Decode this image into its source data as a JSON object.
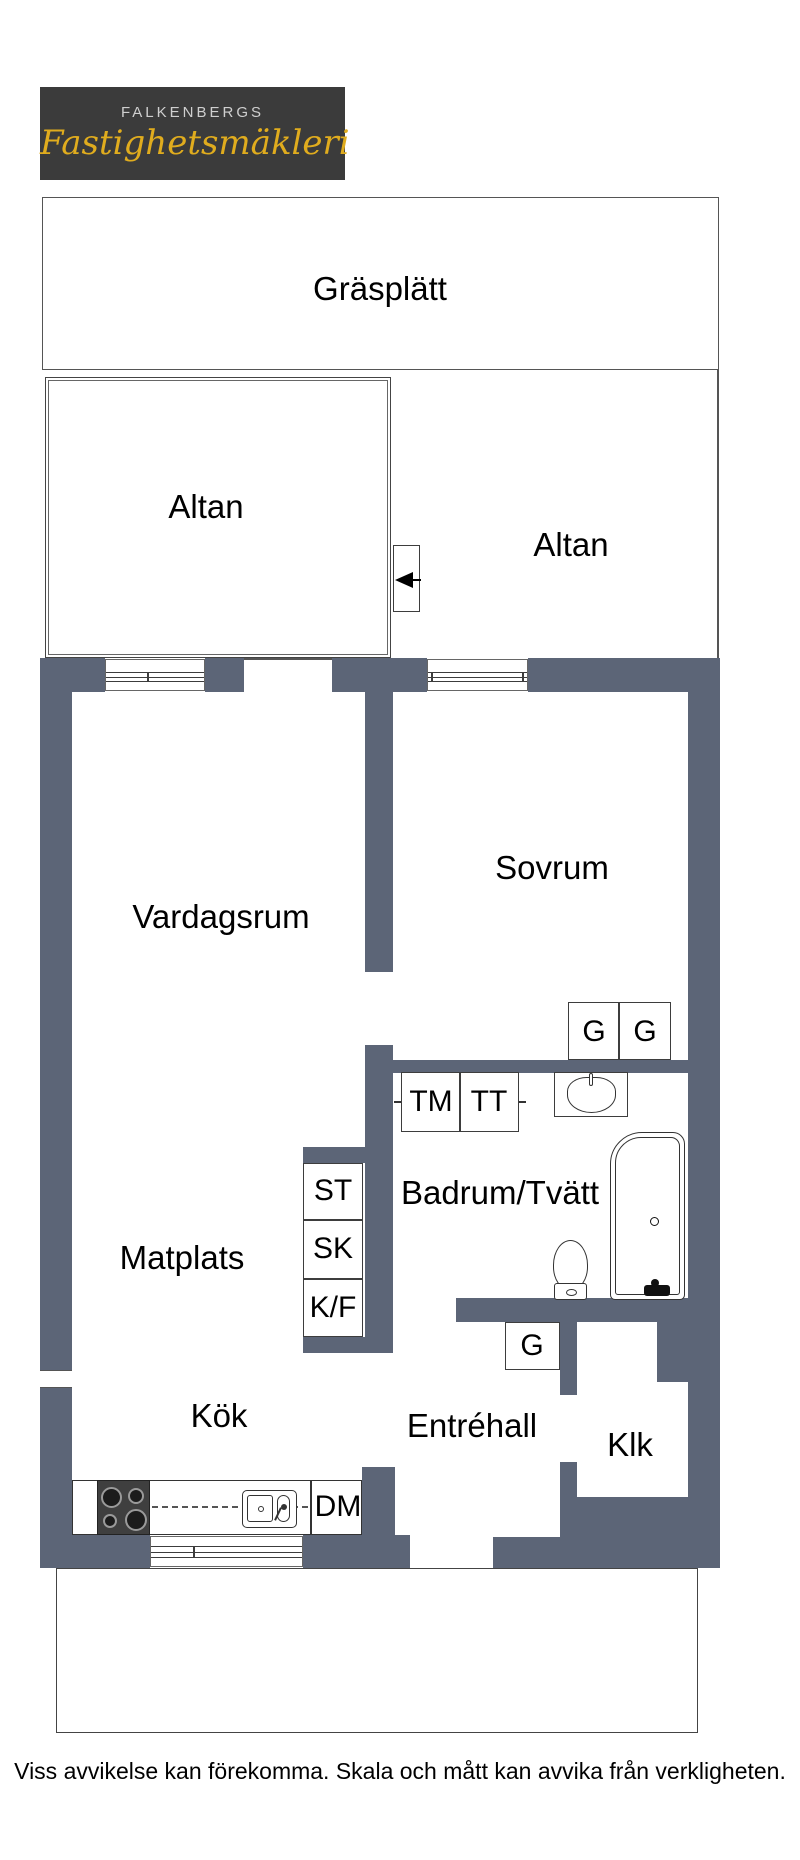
{
  "logo": {
    "line1": "FALKENBERGS",
    "line2": "Fastighetsmäkleri"
  },
  "areas": {
    "grass": "Gräsplätt",
    "patio_left": "Altan",
    "patio_right": "Altan"
  },
  "rooms": {
    "living": "Vardagsrum",
    "bedroom": "Sovrum",
    "dining": "Matplats",
    "bathroom": "Badrum/Tvätt",
    "kitchen": "Kök",
    "hall": "Entréhall",
    "closet": "Klk"
  },
  "fixtures": {
    "wardrobe_a": "G",
    "wardrobe_b": "G",
    "wardrobe_c": "G",
    "washing_machine": "TM",
    "tumble_dryer": "TT",
    "cleaning_cabinet": "ST",
    "cabinet": "SK",
    "fridge_freezer": "K/F",
    "dishwasher": "DM"
  },
  "footer": {
    "disclaimer": "Viss avvikelse kan förekomma. Skala och mått kan avvika från verkligheten."
  },
  "colors": {
    "wall": "#5c6577",
    "logo_bg": "#3b3b3b",
    "logo_gold": "#e0ac1e",
    "logo_text": "#cfcfcf",
    "entrance_arrow_red": "#ee1c24",
    "outline": "#555555"
  }
}
